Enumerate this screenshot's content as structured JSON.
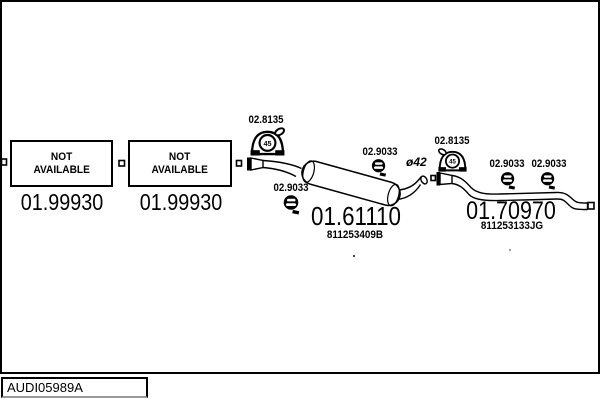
{
  "colors": {
    "ink": "#000000",
    "bg": "#ffffff"
  },
  "footer": {
    "image_code": "AUDI05989A"
  },
  "availability": {
    "box1": {
      "line1": "NOT",
      "line2": "AVAILABLE",
      "code": "01.99930"
    },
    "box2": {
      "line1": "NOT",
      "line2": "AVAILABLE",
      "code": "01.99930"
    }
  },
  "parts": {
    "front_mount": {
      "code": "02.8135",
      "badge": "45"
    },
    "rear_mount": {
      "code": "02.8135",
      "badge": "45"
    },
    "front_clamp": {
      "code": "02.9033"
    },
    "mid_clamp": {
      "code": "02.9033"
    },
    "rear_clamp_1": {
      "code": "02.9033"
    },
    "rear_clamp_2": {
      "code": "02.9033"
    },
    "middle_silencer": {
      "code": "01.61110",
      "part_number": "811253409B"
    },
    "rear_pipe": {
      "code": "01.70970",
      "part_number": "811253133JG"
    },
    "pipe_diameter": "ø42"
  }
}
